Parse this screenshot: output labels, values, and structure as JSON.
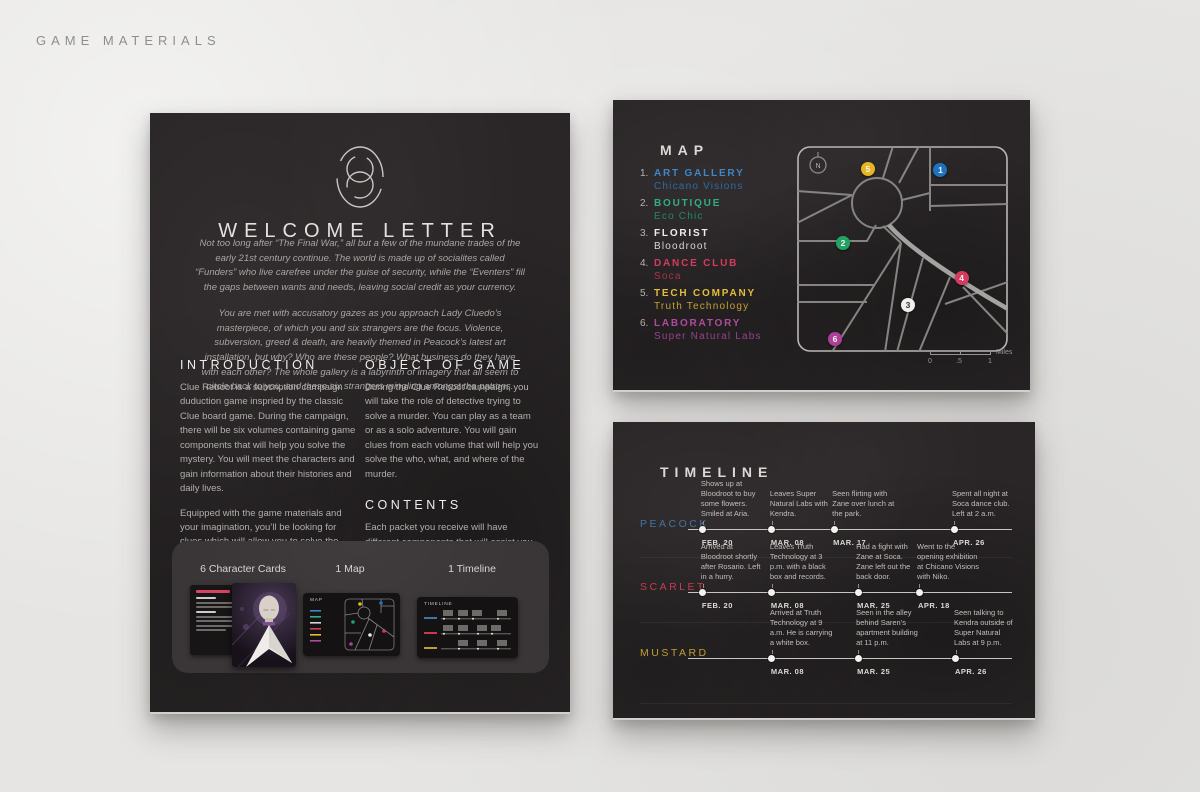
{
  "page": {
    "header": "GAME MATERIALS"
  },
  "letter": {
    "title": "WELCOME LETTER",
    "intro": [
      "Not too long after “The Final War,” all but a few of the mundane trades of the early 21st century continue. The world is made up of socialites called “Funders” who live carefree under the guise of security, while the “Eventers” fill the gaps between wants and needs, leaving social credit as your currency.",
      "You are met with accusatory gazes as you approach Lady Cluedo’s masterpiece, of which you and six strangers are the focus. Violence, subversion, greed & death, are heavily themed in Peacock’s latest art installation, but why? Who are these people? What business do they have with each other? The whole gallery is a labyrinth of imagery that all seem to circle back to you, and these six strangers mingling amongst the patrons."
    ],
    "sections": [
      {
        "heading": "INTRODUCTION",
        "paragraphs": [
          "Clue Reboot is a subcription campaign duduction game inspried by the classic Clue board game. During the campaign, there will be six volumes containing game components that will help you solve the mystery.  You will meet the characters and gain information about their histories and daily lives.",
          "Equipped with the game materials and your imagination, you’ll be looking for clues which will allow you to solve the case and answer a series of questions about the case which will be supplied during the last volume of the campaign. Do you have what it takes?"
        ]
      },
      {
        "heading": "OBJECT OF GAME",
        "paragraphs": [
          "During the Clue Reboot campaign,  you will take the role of detective trying to solve a murder. You can play as a team or as a solo adventure. You will gain clues from each volume that will help you solve the who, what, and where of the murder."
        ]
      },
      {
        "heading": "CONTENTS",
        "paragraphs": [
          "Each packet you receive will have different components that will assist you in solving the case.  Keep all the contents of each box, as you might need to refer back to previous items in order to get all the clues."
        ]
      }
    ],
    "strip": {
      "items": [
        {
          "label": "6 Character Cards"
        },
        {
          "label": "1 Map"
        },
        {
          "label": "1 Timeline"
        }
      ]
    }
  },
  "map_card": {
    "title": "MAP",
    "compass_label": "N",
    "legend": [
      {
        "num": "1.",
        "category": "ART GALLERY",
        "name": "Chicano Visions",
        "color": "#3d86c8",
        "name_color": "#2e6ba3"
      },
      {
        "num": "2.",
        "category": "BOUTIQUE",
        "name": "Eco Chic",
        "color": "#2fae85",
        "name_color": "#238868"
      },
      {
        "num": "3.",
        "category": "FLORIST",
        "name": "Bloodroot",
        "color": "#efedeb",
        "name_color": "#d9d6d4"
      },
      {
        "num": "4.",
        "category": "DANCE CLUB",
        "name": "Soca",
        "color": "#d63a5e",
        "name_color": "#a83350"
      },
      {
        "num": "5.",
        "category": "TECH COMPANY",
        "name": "Truth Technology",
        "color": "#e3bd3a",
        "name_color": "#c2a233"
      },
      {
        "num": "6.",
        "category": "LABORATORY",
        "name": "Super Natural Labs",
        "color": "#b04a9d",
        "name_color": "#97438a"
      }
    ],
    "markers": [
      {
        "num": "1",
        "color": "#1e72c0"
      },
      {
        "num": "2",
        "color": "#22a263"
      },
      {
        "num": "3",
        "color": "#f2efed"
      },
      {
        "num": "4",
        "color": "#d63a5e"
      },
      {
        "num": "5",
        "color": "#e6b722"
      },
      {
        "num": "6",
        "color": "#ae3f99"
      }
    ],
    "scale": {
      "start": "0",
      "mid": ".5",
      "end": "1",
      "unit": "Miles"
    }
  },
  "timeline_card": {
    "title": "TIMELINE",
    "rows": [
      {
        "name": "PEACOCK",
        "color": "#41749f",
        "events": [
          {
            "pos": 4.6,
            "text": "Shows up at Bloodroot to buy some flowers. Smiled at Aria.",
            "date": "FEB. 20"
          },
          {
            "pos": 25.9,
            "text": "Leaves Super Natural Labs with Kendra.",
            "date": "MAR. 08"
          },
          {
            "pos": 45.1,
            "text": "Seen flirting with Zane over lunch at the park.",
            "date": "MAR. 17"
          },
          {
            "pos": 82.1,
            "text": "Spent all night at Soca dance club. Left at 2 a.m.",
            "date": "APR. 26"
          }
        ]
      },
      {
        "name": "SCARLET",
        "color": "#c93a52",
        "events": [
          {
            "pos": 4.6,
            "text": "Arrived at Bloodroot shortly after Rosario. Left in a hurry.",
            "date": "FEB. 20"
          },
          {
            "pos": 25.9,
            "text": "Leaves Truth Technology at 3 p.m. with a black box and records.",
            "date": "MAR. 08"
          },
          {
            "pos": 52.5,
            "text": "Had a fight with Zane at Soca. Zane left out the back door.",
            "date": "MAR. 25"
          },
          {
            "pos": 71.3,
            "text": "Went to the opening exhibition at Chicano Visions with Niko.",
            "date": "APR. 18"
          }
        ]
      },
      {
        "name": "MUSTARD",
        "color": "#c19d33",
        "events": [
          {
            "pos": 25.9,
            "text": "Arrived at Truth Technology at 9 a.m.  He is carrying a white box.",
            "date": "MAR. 08"
          },
          {
            "pos": 52.5,
            "text": "Seen in the alley behind Saren’s apartment building at 11 p.m.",
            "date": "MAR. 25"
          },
          {
            "pos": 82.7,
            "text": "Seen talking to Kendra outside of Super Natural Labs at 9 p.m.",
            "date": "APR. 26"
          }
        ]
      }
    ]
  }
}
